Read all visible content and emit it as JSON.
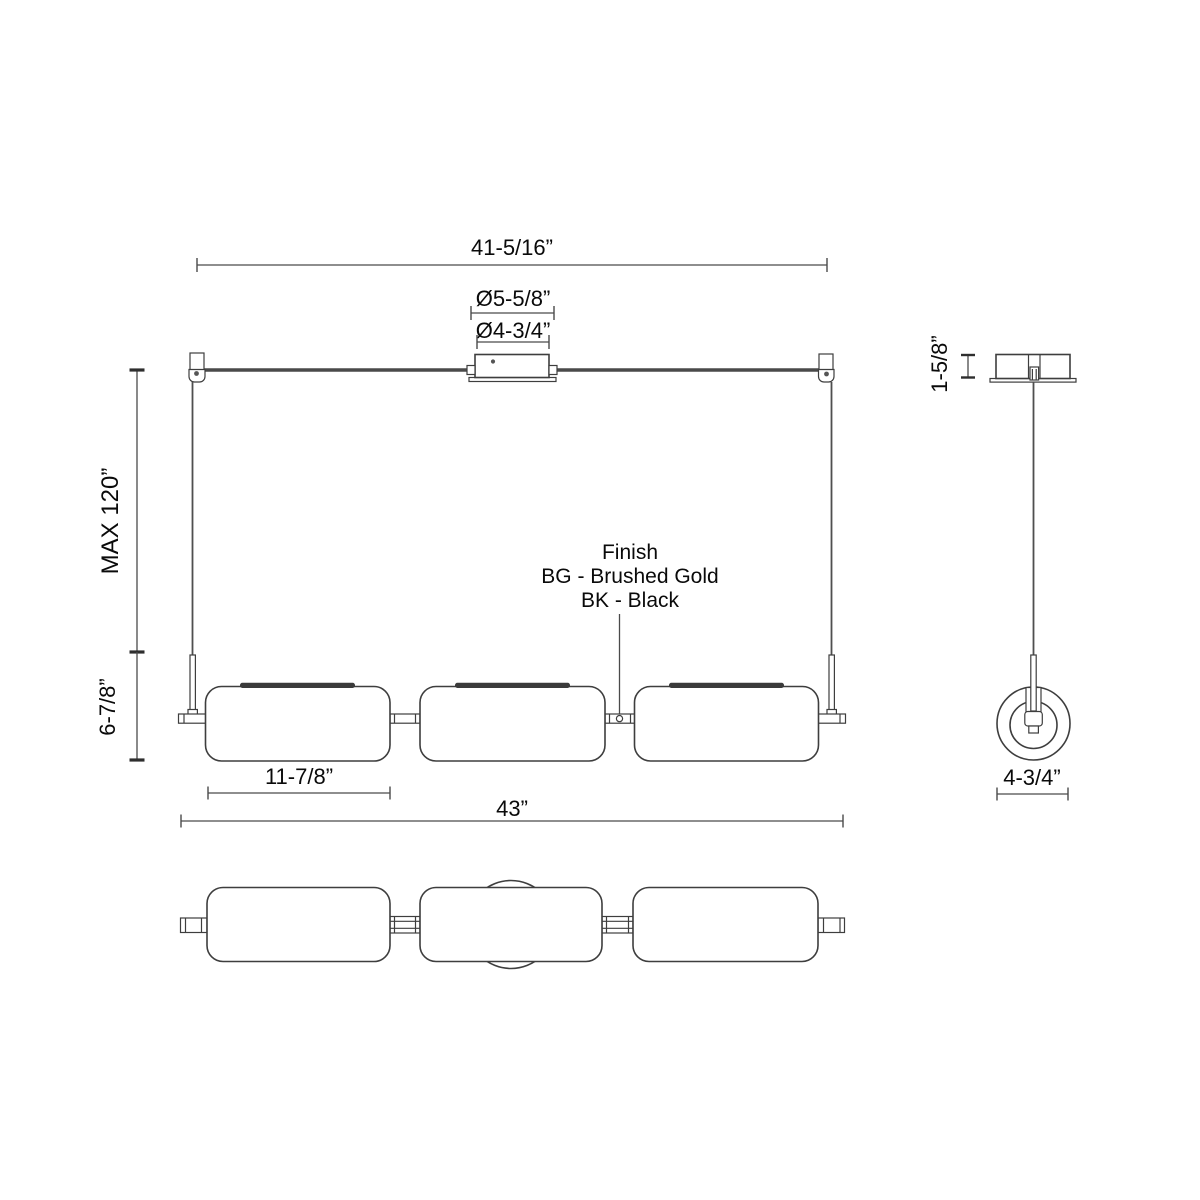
{
  "front_view": {
    "dims": {
      "suspension_span": "41-5/16”",
      "canopy_outer_dia": "Ø5-5/8”",
      "canopy_inner_dia": "Ø4-3/4”",
      "max_drop": "MAX 120”",
      "fixture_height": "6-7/8”",
      "shade_length": "11-7/8”",
      "overall_length": "43”"
    },
    "finish_note": {
      "line1": "Finish",
      "line2": "BG - Brushed Gold",
      "line3": "BK - Black"
    }
  },
  "side_view": {
    "dims": {
      "canopy_height": "1-5/8”",
      "shade_diameter": "4-3/4”"
    }
  },
  "colors": {
    "background": "#ffffff",
    "line": "#3e3e3e",
    "dim_line": "#4a4a4a",
    "text": "#0a0a0a",
    "cap_fill": "#3a3a3a"
  }
}
